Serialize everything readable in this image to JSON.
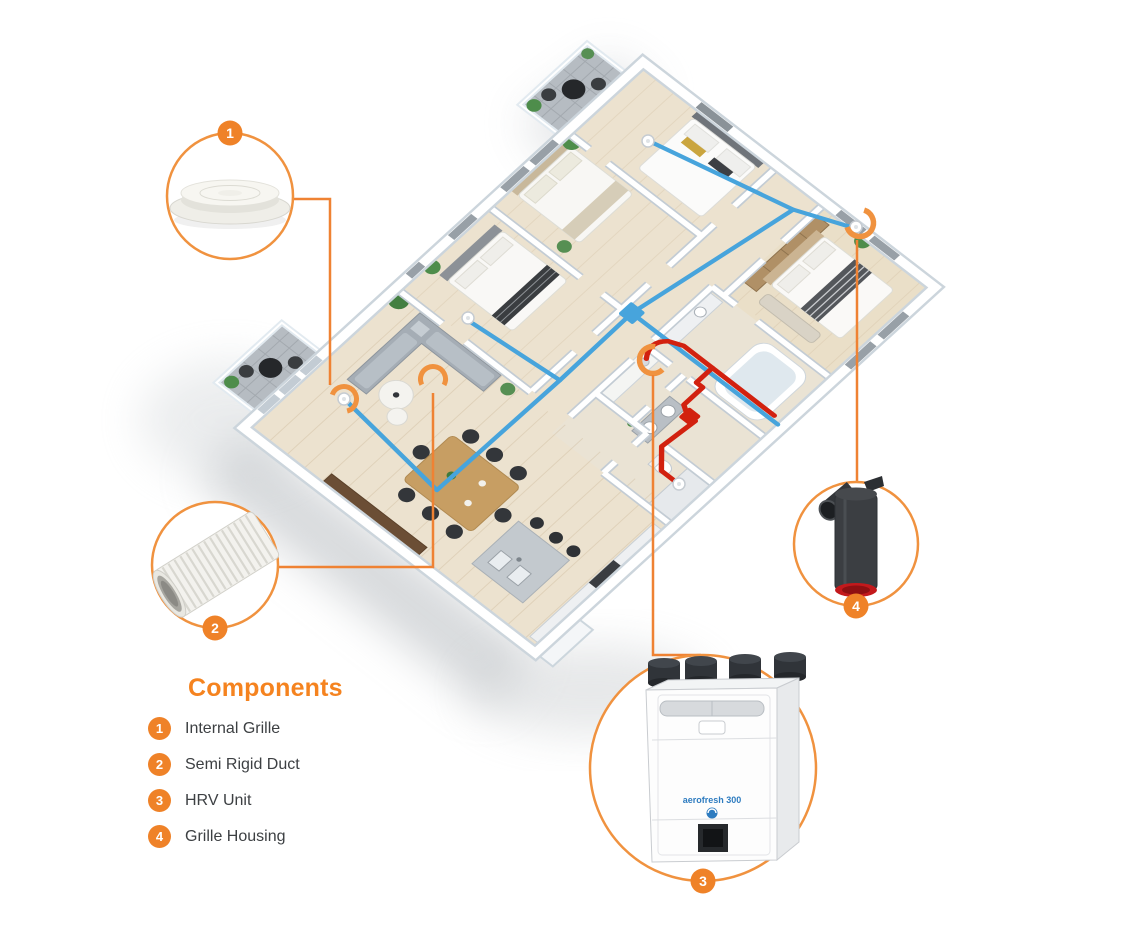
{
  "legend": {
    "title": "Components",
    "items": [
      {
        "number": "1",
        "label": "Internal Grille"
      },
      {
        "number": "2",
        "label": "Semi Rigid Duct"
      },
      {
        "number": "3",
        "label": "HRV Unit"
      },
      {
        "number": "4",
        "label": "Grille Housing"
      }
    ]
  },
  "hrv_unit": {
    "brand": "aerofresh 300"
  },
  "colors": {
    "accent_orange": "#EF8228",
    "supply_blue": "#47A4DC",
    "extract_red": "#D2210F"
  }
}
